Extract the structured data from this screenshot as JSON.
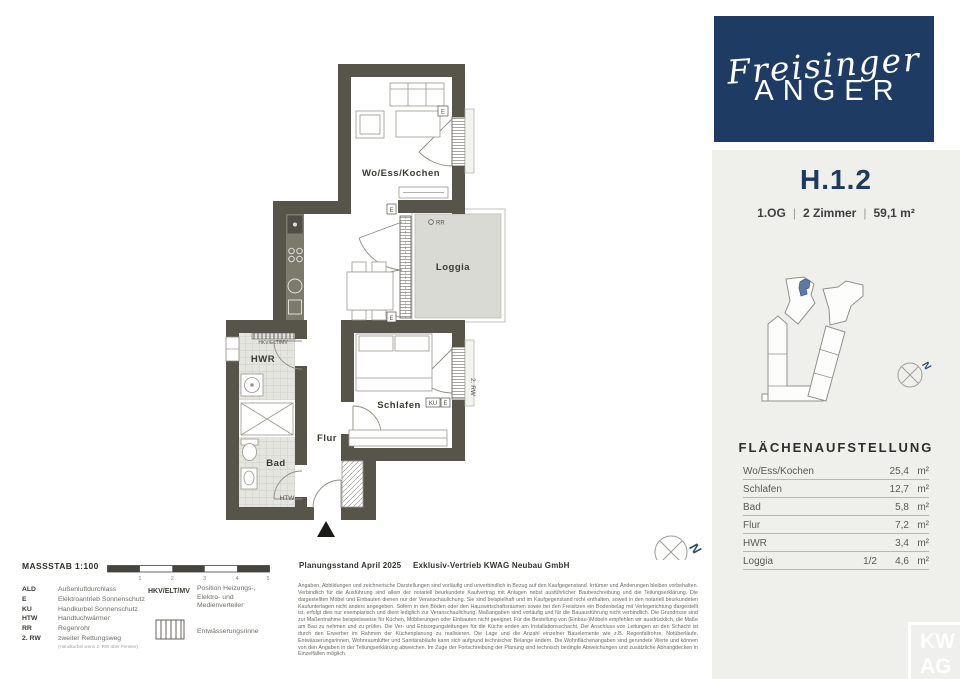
{
  "plan": {
    "rooms": {
      "living": "Wo/Ess/Kochen",
      "loggia": "Loggia",
      "bedroom": "Schlafen",
      "hall": "Flur",
      "bath": "Bad",
      "utility": "HWR"
    },
    "annotations": {
      "htw": "HTW",
      "hkv": "HKV/ELT/MV",
      "rr": "RR",
      "ku": "KU",
      "e": "E",
      "rw2": "2. RW",
      "north": "N"
    }
  },
  "legend": {
    "massstab": "MASSSTAB 1:100",
    "scale_ticks": [
      "1",
      "2",
      "3",
      "4",
      "5"
    ],
    "items": [
      {
        "abbr": "ALD",
        "text": "Außenluftdurchlass"
      },
      {
        "abbr": "E",
        "text": "Elektroantrieb Sonnenschutz"
      },
      {
        "abbr": "KU",
        "text": "Handkurbel Sonnenschutz"
      },
      {
        "abbr": "HTW",
        "text": "Handtuchwärmer"
      },
      {
        "abbr": "RR",
        "text": "Regenrohr"
      },
      {
        "abbr": "2. RW",
        "text": "zweiter Rettungsweg",
        "note": "(Handkurbel wenn 2. RW über Fenster)"
      }
    ],
    "hkv_abbr": "HKV/ELT/MV",
    "hkv_text": "Position Heizungs-, Elektro- und Medienverteiler",
    "rinne_label": "Entwässerungsrinne"
  },
  "footer": {
    "planungsstand": "Planungsstand April 2025",
    "vertrieb": "Exklusiv-Vertrieb KWAG Neubau GmbH",
    "disclaimer": "Angaben, Abbildungen und zeichnerische Darstellungen sind vorläufig und unverbindlich in Bezug auf den Kaufgegenstand. Irrtümer und Änderungen bleiben vorbehalten. Verbindlich für die Ausführung sind allein der notariell beurkundete Kaufvertrag mit Anlagen nebst ausführlicher Baubeschreibung und die Teilungserklärung. Die dargestellten Möbel und Einbauten dienen nur der Veranschaulichung. Sie sind beispielhaft und im Kaufgegenstand nicht enthalten, soweit in den notariell beurkundeten Kaufunterlagen nicht anders angegeben. Sofern in den Böden oder den Hauswirtschaftsräumen sowie bei den Freisitzen ein Bodenbelag mit Verlegerichtung dargestellt ist, erfolgt dies nur exemplarisch und dient lediglich zur Veranschaulichung. Maßangaben sind vorläufig und für die Bauausführung nicht verbindlich. Die Grundrisse sind zur Maßentnahme beispielsweise für Küchen, Möblierungen oder Einbauten nicht geeignet. Für die Bestellung von (Einbau-)Möbeln empfehlen wir ausdrücklich, die Maße am Bau zu nehmen und zu prüfen. Die Ver- und Entsorgungsleitungen für die Küche enden am Installationsschacht. Der Anschluss von Leitungen an den Schacht ist durch den Erwerber im Rahmen der Küchenplanung zu realisieren. Die Lage und die Anzahl einzelner Bauelemente wie z.B. Regenfallrohre, Notüberläufe, Entwässerungsrinnen, Wohnraumlüfter und Sanitärabläufe kann sich aufgrund technischer Belange ändern. Die Wohnflächenangaben sind gerundete Werte und können von den Angaben in der Teilungserklärung abweichen. Im Zuge der Fortschreibung der Planung sind technisch bedingte Abweichungen und zusätzliche Abhangdecken in Einzelfällen möglich."
  },
  "panel": {
    "brand_script": "Freisinger",
    "brand_caps": "ANGER",
    "unit_id": "H.1.2",
    "meta": {
      "floor": "1.OG",
      "rooms": "2 Zimmer",
      "area": "59,1 m²",
      "sep": "|"
    },
    "areas_title": "FLÄCHENAUFSTELLUNG",
    "area_rows": [
      {
        "label": "Wo/Ess/Kochen",
        "fraction": "",
        "value": "25,4",
        "unit": "m²"
      },
      {
        "label": "Schlafen",
        "fraction": "",
        "value": "12,7",
        "unit": "m²"
      },
      {
        "label": "Bad",
        "fraction": "",
        "value": "5,8",
        "unit": "m²"
      },
      {
        "label": "Flur",
        "fraction": "",
        "value": "7,2",
        "unit": "m²"
      },
      {
        "label": "HWR",
        "fraction": "",
        "value": "3,4",
        "unit": "m²"
      },
      {
        "label": "Loggia",
        "fraction": "1/2",
        "value": "4,6",
        "unit": "m²"
      }
    ],
    "watermark": {
      "line1": "KW",
      "line2": "AG"
    }
  },
  "colors": {
    "wall": "#57544a",
    "brand_blue": "#1e3b63",
    "accent_blue": "#2c4a74",
    "panel_gray": "#efefec",
    "loggia_floor": "#d9dad4",
    "unit_highlight": "#5b7da3"
  }
}
